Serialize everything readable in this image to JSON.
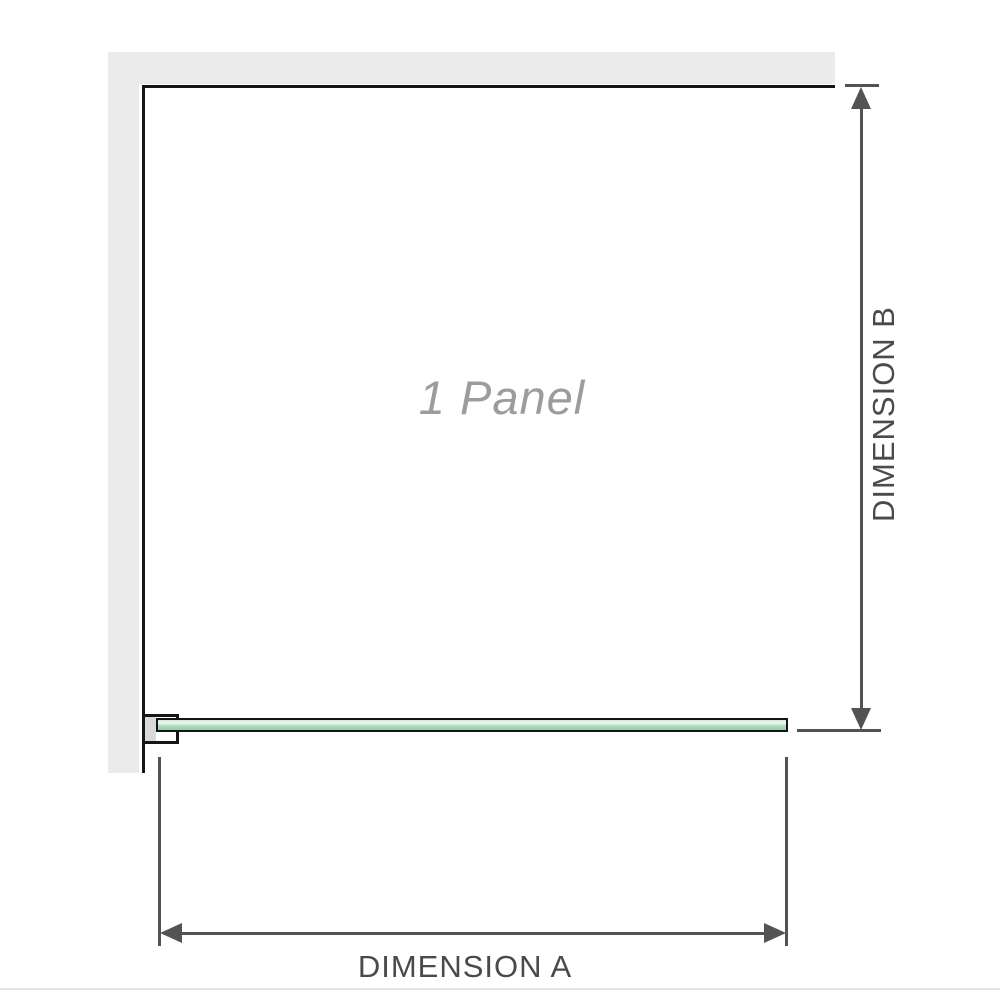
{
  "diagram": {
    "panel": {
      "label": "1 Panel"
    },
    "dimensions": {
      "a": {
        "label": "DIMENSION A",
        "orientation": "horizontal"
      },
      "b": {
        "label": "DIMENSION B",
        "orientation": "vertical"
      }
    },
    "colors": {
      "wall": "#ebebeb",
      "outline": "#151515",
      "dimension_line": "#535353",
      "dimension_text": "#4a4a4a",
      "panel_text": "#9c9c9c",
      "glass_top": "#cfe9da",
      "glass_highlight": "#eef8f2",
      "glass_body": "#a6d8bb",
      "glass_bottom": "#95cfac",
      "bracket_pad": "#d9d9d9",
      "bottom_edge": "#e3e3e3"
    }
  }
}
